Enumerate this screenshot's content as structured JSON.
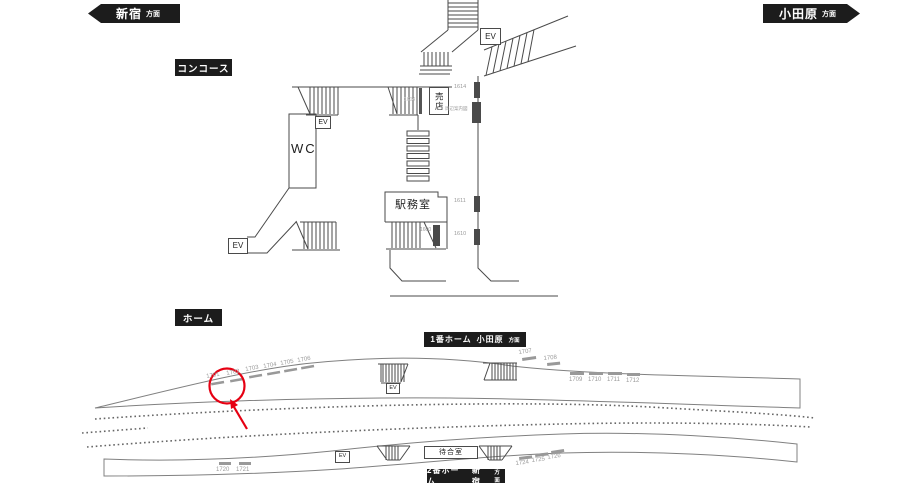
{
  "directions": {
    "left": {
      "station": "新宿",
      "suffix": "方面"
    },
    "right": {
      "station": "小田原",
      "suffix": "方面"
    }
  },
  "sections": {
    "concourse": "コンコース",
    "platform_area": "ホーム"
  },
  "platform_badges": {
    "platform1": {
      "line": "1番ホーム",
      "direction": "小田原",
      "suffix": "方面"
    },
    "platform2": {
      "line": "2番ホーム",
      "direction": "新宿",
      "suffix": "方面"
    }
  },
  "rooms": {
    "wc": "WC",
    "ev": "EV",
    "shop": "売店",
    "office": "駅務室",
    "waiting_room": "待合室"
  },
  "ads": {
    "highlighted": "1701",
    "concourse": [
      {
        "id": "1614"
      },
      {
        "id": "周辺案内図"
      },
      {
        "id": "1611"
      },
      {
        "id": "1610"
      },
      {
        "id": "1600"
      },
      {
        "id": "1604"
      }
    ],
    "platform1": [
      {
        "id": "1701"
      },
      {
        "id": "1702"
      },
      {
        "id": "1703"
      },
      {
        "id": "1704"
      },
      {
        "id": "1705"
      },
      {
        "id": "1706"
      },
      {
        "id": "1707"
      },
      {
        "id": "1708"
      },
      {
        "id": "1709"
      },
      {
        "id": "1710"
      },
      {
        "id": "1711"
      },
      {
        "id": "1712"
      }
    ],
    "platform2": [
      {
        "id": "1720"
      },
      {
        "id": "1721"
      },
      {
        "id": "1724"
      },
      {
        "id": "1725"
      },
      {
        "id": "1726"
      }
    ]
  },
  "colors": {
    "badge_bg": "#1c1c1c",
    "badge_text": "#ffffff",
    "wall_line": "#4a4a4a",
    "platform_line": "#808080",
    "ad_text": "#9a9a9a",
    "wall_marker": "#4a4a4a",
    "highlight": "#e60012"
  }
}
